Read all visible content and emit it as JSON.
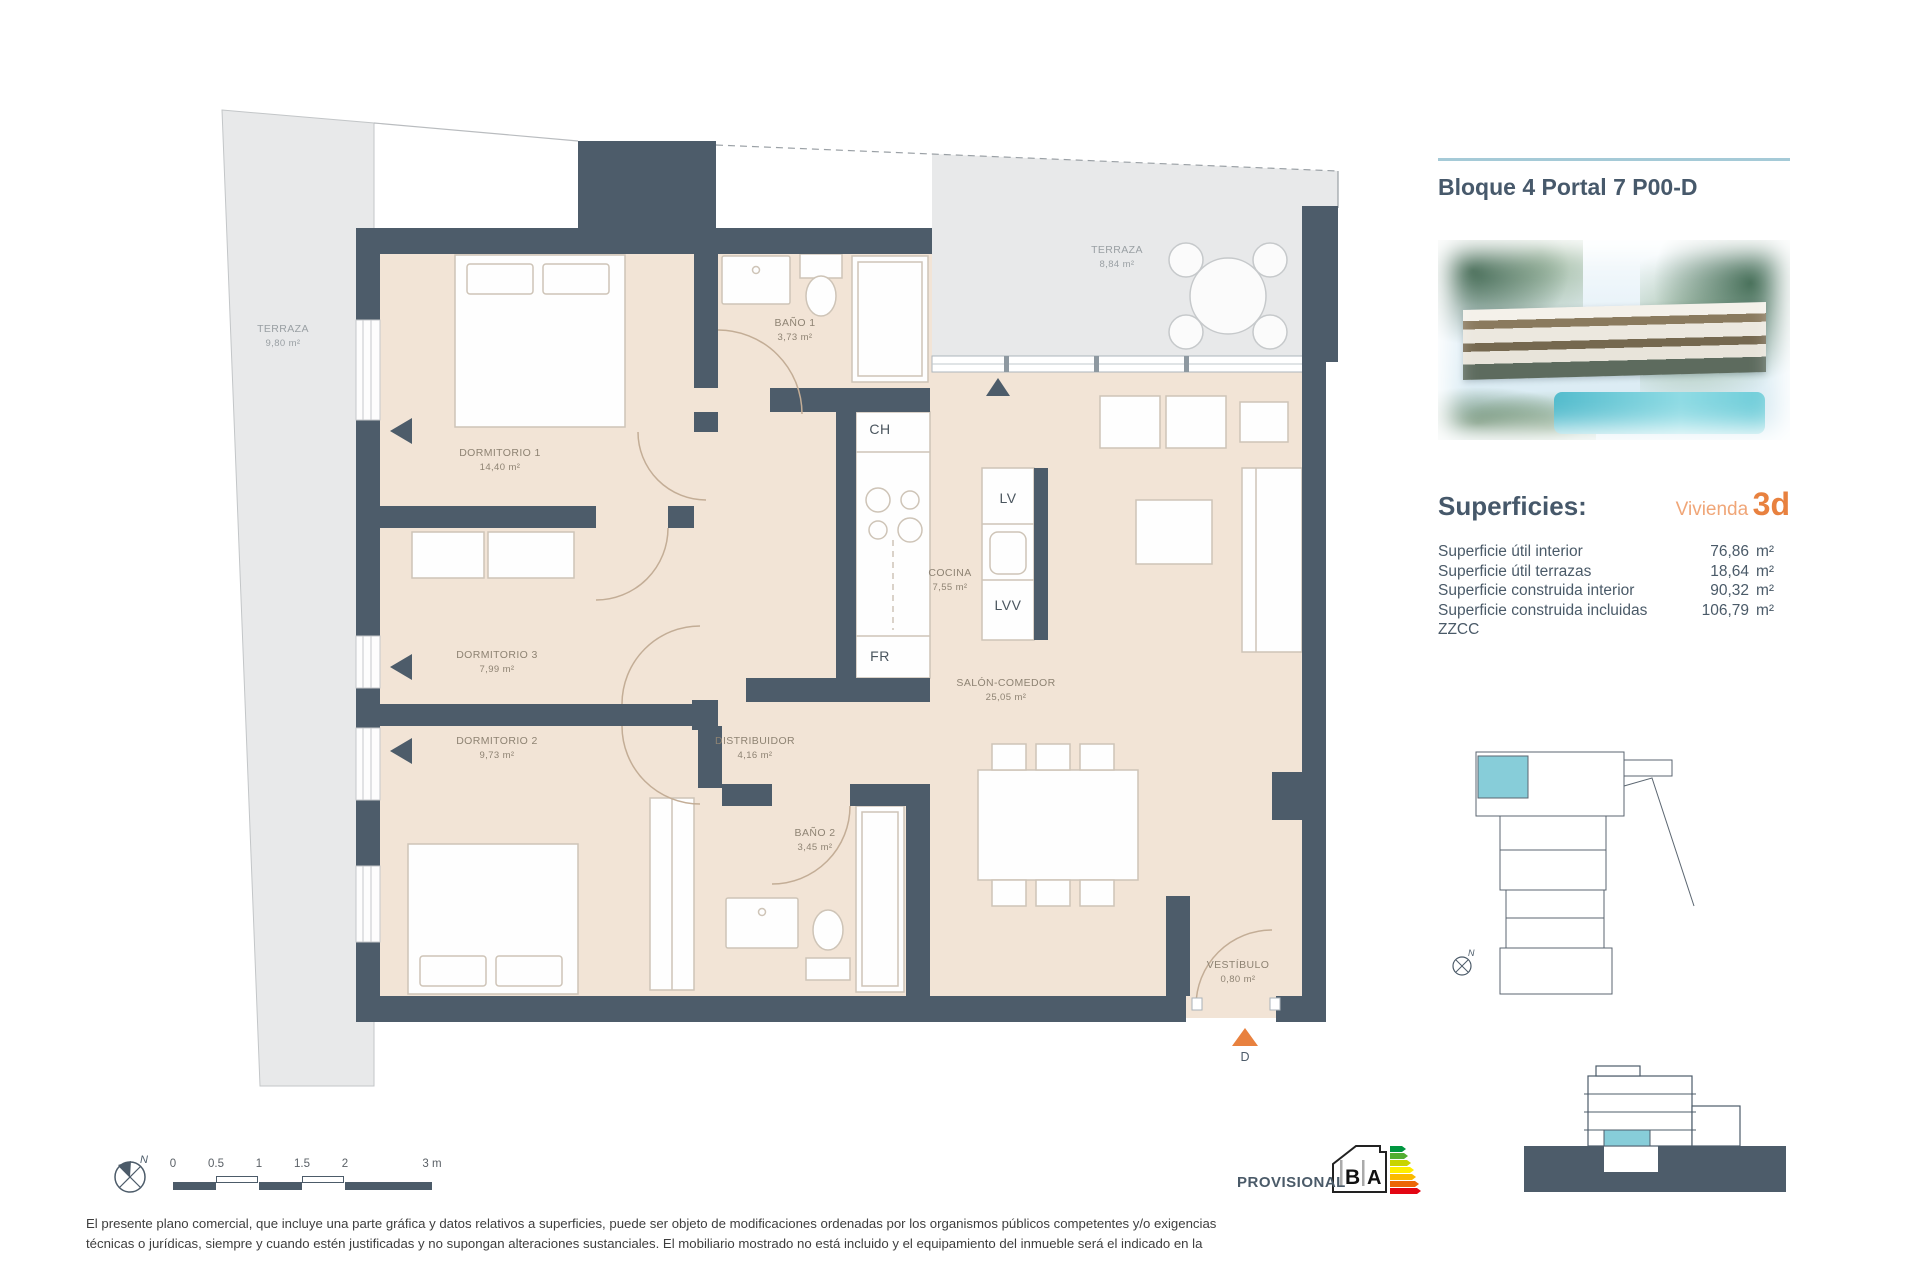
{
  "header": {
    "title": "Bloque 4 Portal 7 P00-D"
  },
  "superficies": {
    "heading": "Superficies:",
    "vivienda_label": "Vivienda",
    "vivienda_code": "3d",
    "rows": [
      {
        "label": "Superficie útil interior",
        "value": "76,86",
        "unit": "m²"
      },
      {
        "label": "Superficie útil terrazas",
        "value": "18,64",
        "unit": "m²"
      },
      {
        "label": "Superficie construida interior",
        "value": "90,32",
        "unit": "m²"
      },
      {
        "label": "Superficie construida incluidas ZZCC",
        "value": "106,79",
        "unit": "m²"
      }
    ]
  },
  "plan": {
    "rooms": [
      {
        "name": "TERRAZA",
        "area": "9,80 m²"
      },
      {
        "name": "DORMITORIO 1",
        "area": "14,40 m²"
      },
      {
        "name": "BAÑO 1",
        "area": "3,73 m²"
      },
      {
        "name": "TERRAZA",
        "area": "8,84 m²"
      },
      {
        "name": "COCINA",
        "area": "7,55 m²"
      },
      {
        "name": "DORMITORIO 3",
        "area": "7,99 m²"
      },
      {
        "name": "SALÓN-COMEDOR",
        "area": "25,05 m²"
      },
      {
        "name": "DORMITORIO 2",
        "area": "9,73 m²"
      },
      {
        "name": "DISTRIBUIDOR",
        "area": "4,16 m²"
      },
      {
        "name": "BAÑO 2",
        "area": "3,45 m²"
      },
      {
        "name": "VESTÍBULO",
        "area": "0,80 m²"
      }
    ],
    "appliances": {
      "ch": "CH",
      "lv": "LV",
      "lvv": "LVV",
      "fr": "FR"
    },
    "entrance_label": "D",
    "compass_n": "N"
  },
  "scalebar": {
    "ticks": [
      "0",
      "0.5",
      "1",
      "1.5",
      "2",
      "3 m"
    ]
  },
  "footer": {
    "provisional": "PROVISIONAL",
    "energy_letter_b": "B",
    "energy_letter_a": "A",
    "disclaimer_line1": "El presente plano comercial, que incluye una parte gráfica y datos relativos a superficies, puede ser objeto de modificaciones ordenadas por los organismos públicos competentes y/o exigencias",
    "disclaimer_line2": "técnicas o jurídicas, siempre y cuando estén justificadas y no supongan alteraciones sustanciales. El mobiliario mostrado no está incluido y el equipamiento del inmueble será el indicado en la"
  },
  "colors": {
    "wall": "#4d5c6a",
    "floor_beige": "#f2e4d6",
    "accent_orange": "#e8813f",
    "title_slate": "#47596b",
    "unit_highlight_cyan": "#87cdd9"
  }
}
